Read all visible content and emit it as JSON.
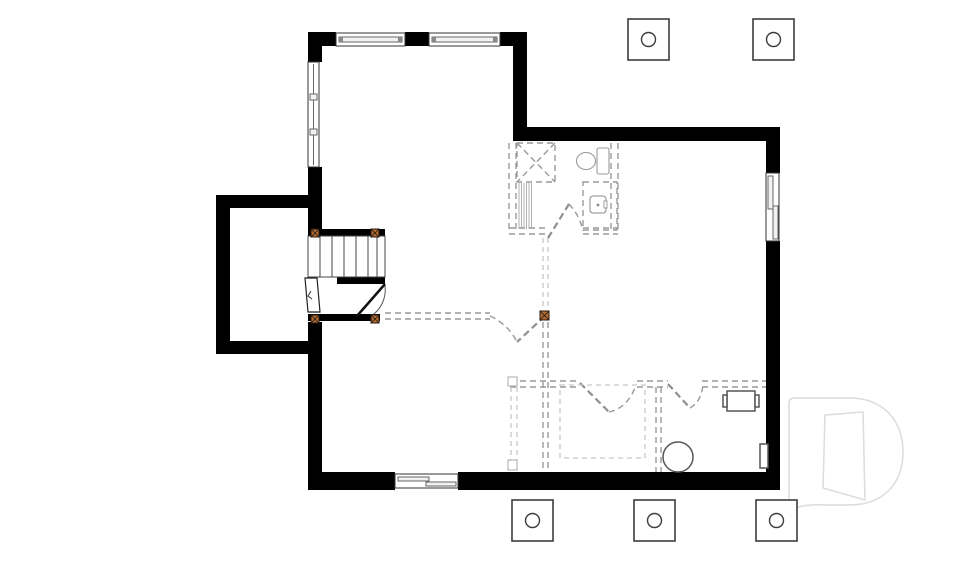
{
  "meta": {
    "drawing_type": "basement-floor-plan",
    "visible_text": "none"
  },
  "colors": {
    "background": "#ffffff",
    "wall": "#000000",
    "outline": "#3c3c3c",
    "proposed_wall": "#999999",
    "future_wall": "#c6c6c6",
    "post_fill": "#b06a33",
    "post_border": "#2b1508",
    "post_cross": "#1a1a1a",
    "watermark": "#dcdcdc"
  },
  "footings": {
    "label": "column-footing",
    "size": 41,
    "circle_radius": 7,
    "items": [
      {
        "x": 628,
        "y": 19
      },
      {
        "x": 753,
        "y": 19
      },
      {
        "x": 512,
        "y": 500
      },
      {
        "x": 634,
        "y": 500
      },
      {
        "x": 756,
        "y": 500
      }
    ]
  },
  "posts": {
    "label": "support-post",
    "items": [
      {
        "x": 311,
        "y": 229,
        "s": 8
      },
      {
        "x": 371,
        "y": 229,
        "s": 8
      },
      {
        "x": 311,
        "y": 315,
        "s": 8
      },
      {
        "x": 371,
        "y": 315,
        "s": 8
      },
      {
        "x": 540,
        "y": 311,
        "s": 9
      }
    ]
  },
  "fixtures": [
    "shower",
    "toilet",
    "vanity-sink",
    "sump-pit",
    "furnace",
    "electrical-panel",
    "staircase",
    "cellar-door",
    "stair-door"
  ],
  "windows": [
    "top-window-left",
    "top-window-right",
    "left-wall-window",
    "right-wall-window",
    "bottom-wall-window"
  ],
  "watermark": {
    "shape": "letter-D-logo"
  }
}
